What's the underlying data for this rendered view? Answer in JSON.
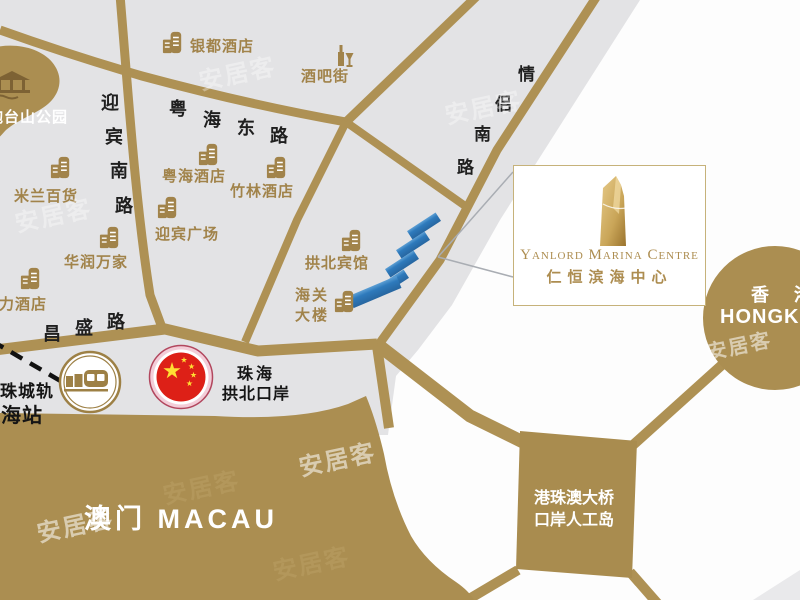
{
  "watermark_text": "安居客",
  "park": {
    "label": "炮台山公园"
  },
  "roads": {
    "yingbin_south": "迎宾南路",
    "yuehai_east": "粤海东路",
    "qinglv_south": "情侣南路",
    "changsheng": "昌盛路"
  },
  "pois": [
    {
      "label": "银都酒店"
    },
    {
      "label": "酒吧街"
    },
    {
      "label": "米兰百货"
    },
    {
      "label": "粤海酒店"
    },
    {
      "label": "竹林酒店"
    },
    {
      "label": "迎宾广场"
    },
    {
      "label": "华润万家"
    },
    {
      "label": "魅力酒店"
    },
    {
      "label": "拱北宾馆"
    },
    {
      "label_line1": "海关",
      "label_line2": "大楼"
    }
  ],
  "station": {
    "line1": "广珠城轨",
    "line2": "珠海站"
  },
  "border_gate": {
    "line1": "珠海",
    "line2": "拱北口岸"
  },
  "project": {
    "name_en": "Yanlord Marina Centre",
    "name_cn": "仁恒滨海中心"
  },
  "bridge_island": {
    "line1": "港珠澳大桥",
    "line2": "口岸人工岛"
  },
  "hongkong": {
    "cn": "香 港",
    "en": "HONGKONG"
  },
  "macau": {
    "label": "澳门 MACAU"
  },
  "colors": {
    "gold_land": "#ab8e51",
    "gold_road": "#ae9154",
    "gray_land": "#e3e3e5",
    "poi_gold": "#a1834a",
    "site_blue": "#2e7abc",
    "flag_red": "#dd2017",
    "star_gold": "#ffde33"
  }
}
